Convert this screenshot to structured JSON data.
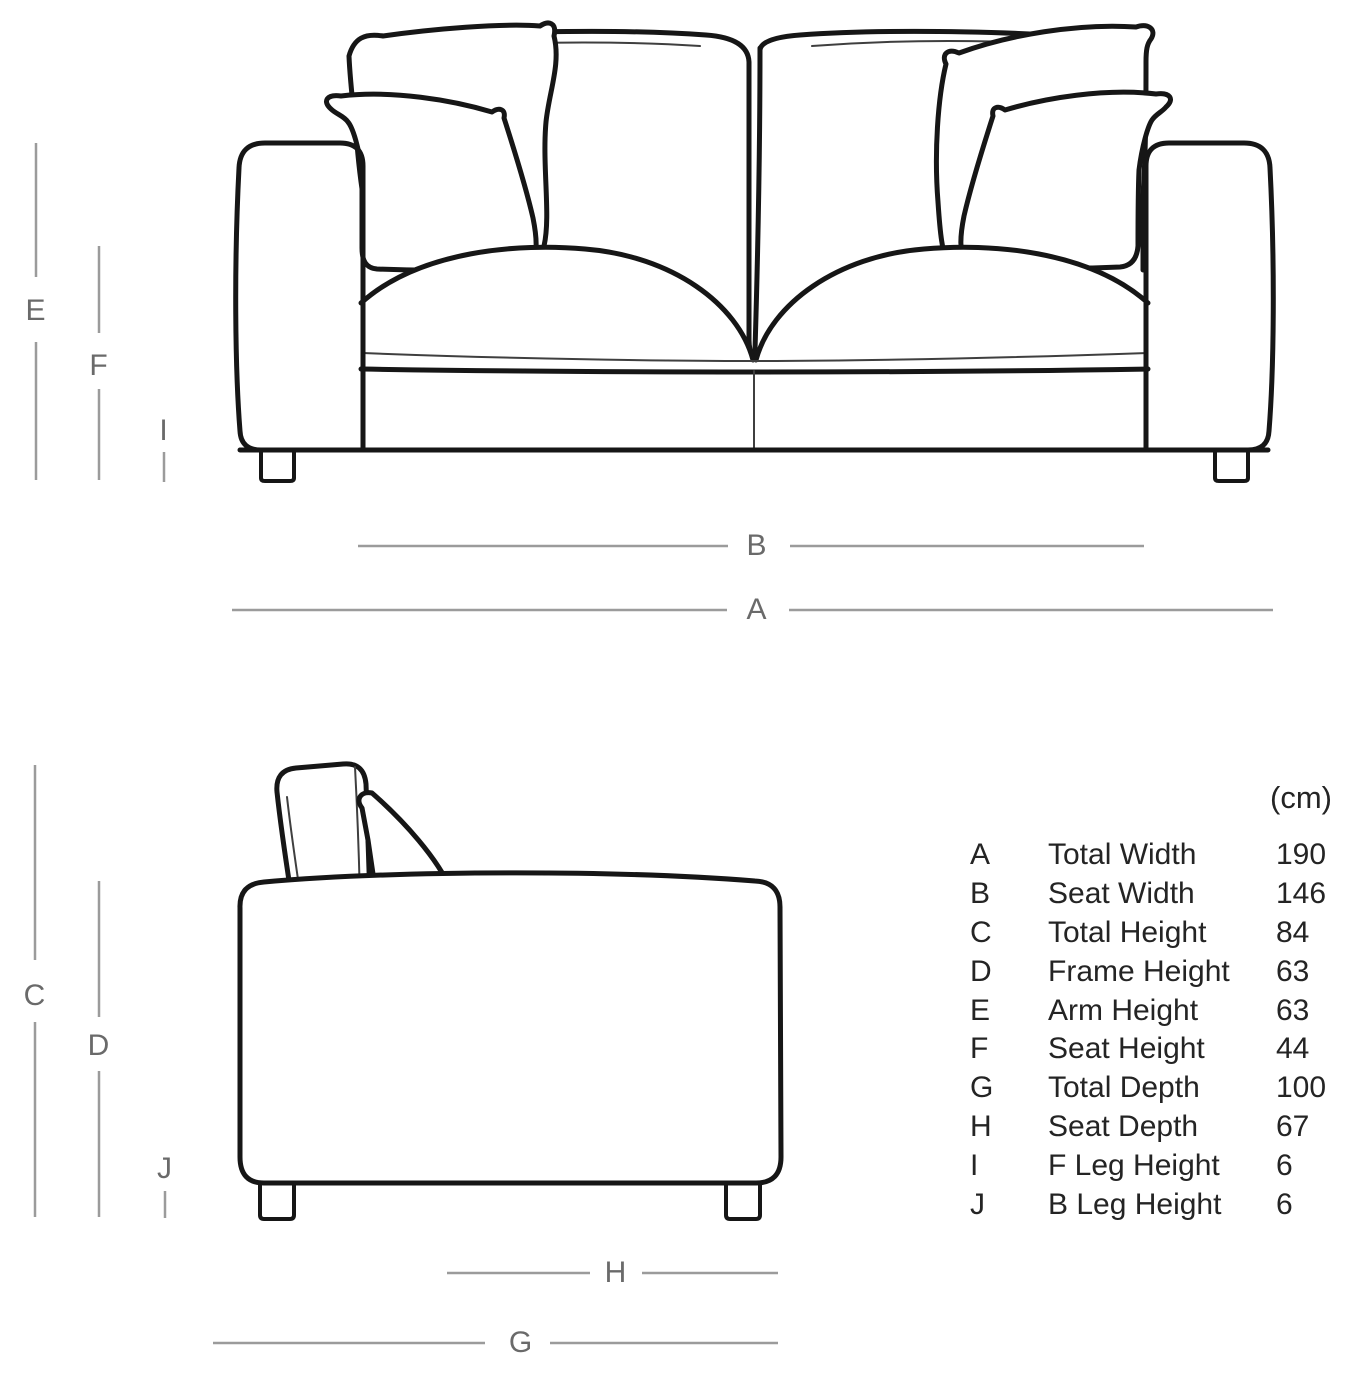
{
  "unit_label": "(cm)",
  "table": {
    "rows": [
      {
        "letter": "A",
        "name": "Total Width",
        "value": "190"
      },
      {
        "letter": "B",
        "name": "Seat Width",
        "value": "146"
      },
      {
        "letter": "C",
        "name": "Total Height",
        "value": "84"
      },
      {
        "letter": "D",
        "name": "Frame Height",
        "value": "63"
      },
      {
        "letter": "E",
        "name": "Arm Height",
        "value": "63"
      },
      {
        "letter": "F",
        "name": "Seat Height",
        "value": "44"
      },
      {
        "letter": "G",
        "name": "Total Depth",
        "value": "100"
      },
      {
        "letter": "H",
        "name": "Seat Depth",
        "value": "67"
      },
      {
        "letter": "I",
        "name": "F Leg Height",
        "value": "6"
      },
      {
        "letter": "J",
        "name": "B Leg Height",
        "value": "6"
      }
    ]
  },
  "colors": {
    "background": "#ffffff",
    "outline": "#161616",
    "seam": "#3f3f3f",
    "dimension-line": "#9b9b9b",
    "dimension-letter": "#6a6a6a",
    "table-text": "#242424"
  }
}
